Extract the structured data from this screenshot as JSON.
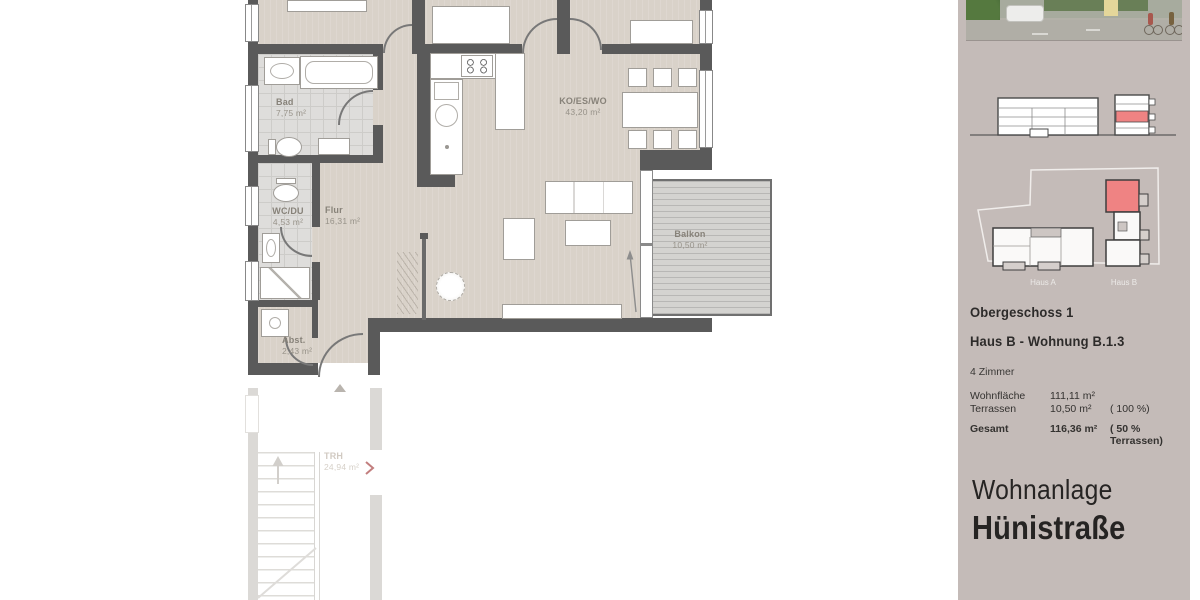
{
  "floorplan": {
    "rooms": [
      {
        "name": "Bad",
        "area": "7,75 m²"
      },
      {
        "name": "WC/DU",
        "area": "4,53 m²"
      },
      {
        "name": "Flur",
        "area": "16,31 m²"
      },
      {
        "name": "Abst.",
        "area": "2,43 m²"
      },
      {
        "name": "KO/ES/WO",
        "area": "43,20 m²"
      },
      {
        "name": "Balkon",
        "area": "10,50 m²"
      },
      {
        "name": "TRH",
        "area": "24,94 m²"
      }
    ]
  },
  "sidebar": {
    "colors": {
      "highlight_red": "#ef8383",
      "background": "#c4bbb8"
    },
    "site_plan": {
      "haus_a": "Haus A",
      "haus_b": "Haus B"
    },
    "info": {
      "floor": "Obergeschoss 1",
      "unit": "Haus B  -  Wohnung  B.1.3",
      "rooms": "4 Zimmer",
      "rows": [
        {
          "label": "Wohnfläche",
          "value": "111,11  m²",
          "note": ""
        },
        {
          "label": "Terrassen",
          "value": "10,50 m²",
          "note": "( 100 %)"
        },
        {
          "label": "Gesamt",
          "value": "116,36 m²",
          "note": "(  50 % Terrassen)"
        }
      ]
    },
    "project": {
      "line1": "Wohnanlage",
      "line2": "Hünistraße"
    }
  }
}
